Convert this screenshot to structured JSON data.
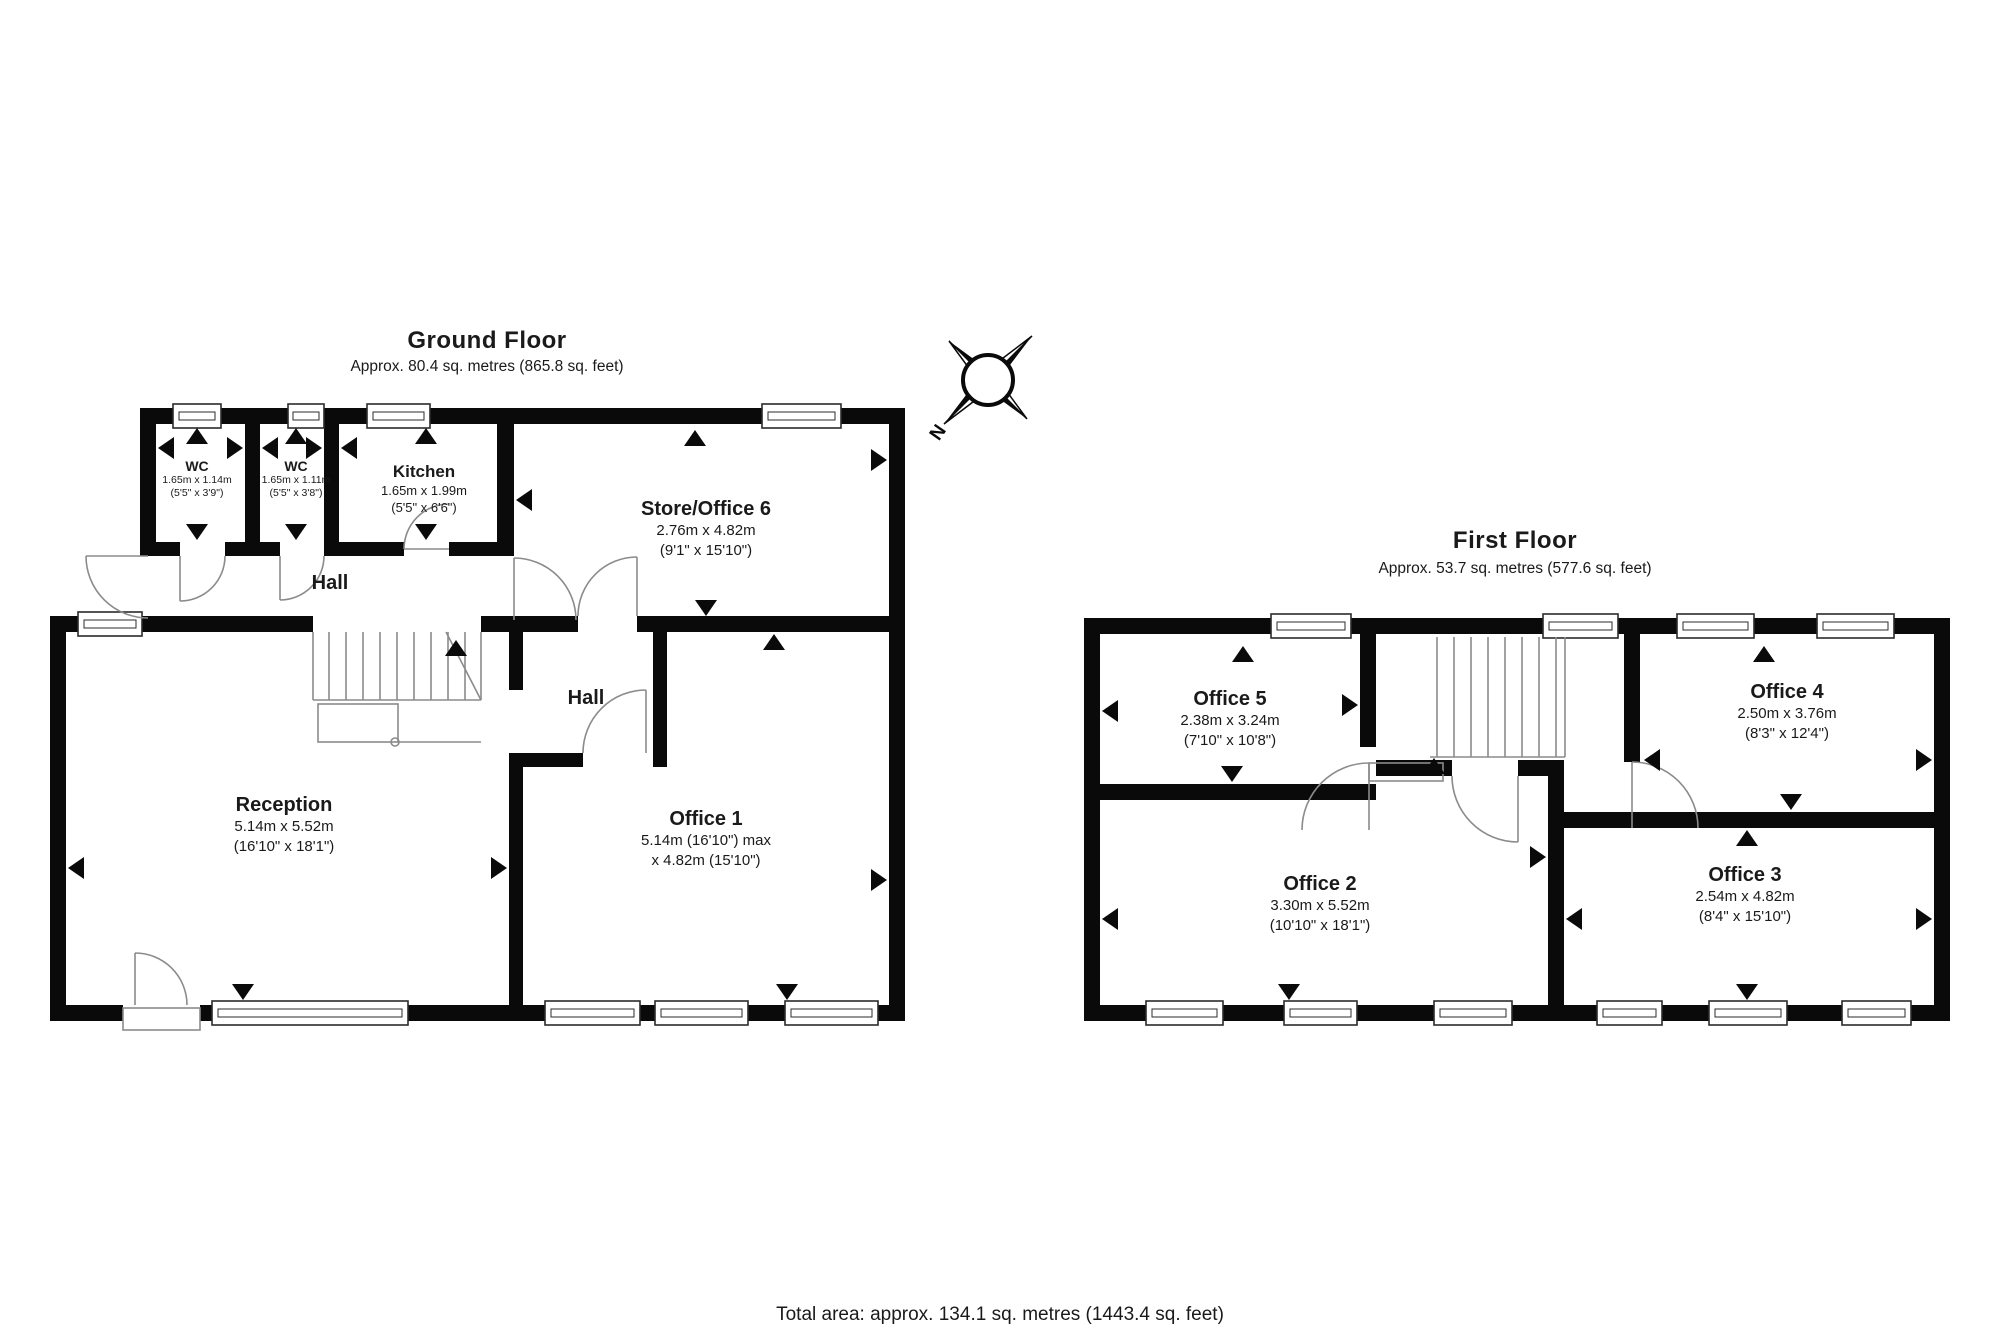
{
  "page": {
    "footer": "Total area: approx. 134.1 sq. metres (1443.4 sq. feet)"
  },
  "compass": {
    "north": "N"
  },
  "ground_floor": {
    "title": "Ground Floor",
    "subtitle": "Approx. 80.4 sq. metres (865.8 sq. feet)",
    "hall_upper": "Hall",
    "hall_lower": "Hall",
    "rooms": [
      {
        "name": "WC",
        "dims_m": "1.65m x 1.14m",
        "dims_ft": "(5'5\" x 3'9\")"
      },
      {
        "name": "WC",
        "dims_m": "1.65m x 1.11m",
        "dims_ft": "(5'5\" x 3'8\")"
      },
      {
        "name": "Kitchen",
        "dims_m": "1.65m x 1.99m",
        "dims_ft": "(5'5\" x 6'6\")"
      },
      {
        "name": "Store/Office 6",
        "dims_m": "2.76m x 4.82m",
        "dims_ft": "(9'1\" x 15'10\")"
      },
      {
        "name": "Reception",
        "dims_m": "5.14m x 5.52m",
        "dims_ft": "(16'10\" x 18'1\")"
      },
      {
        "name": "Office 1",
        "dims_m": "5.14m (16'10\") max",
        "dims_ft": "x 4.82m (15'10\")"
      }
    ]
  },
  "first_floor": {
    "title": "First Floor",
    "subtitle": "Approx. 53.7 sq. metres (577.6 sq. feet)",
    "rooms": [
      {
        "name": "Office 5",
        "dims_m": "2.38m x 3.24m",
        "dims_ft": "(7'10\" x 10'8\")"
      },
      {
        "name": "Office 4",
        "dims_m": "2.50m x 3.76m",
        "dims_ft": "(8'3\" x 12'4\")"
      },
      {
        "name": "Office 2",
        "dims_m": "3.30m x 5.52m",
        "dims_ft": "(10'10\" x 18'1\")"
      },
      {
        "name": "Office 3",
        "dims_m": "2.54m x 4.82m",
        "dims_ft": "(8'4\" x 15'10\")"
      }
    ]
  }
}
